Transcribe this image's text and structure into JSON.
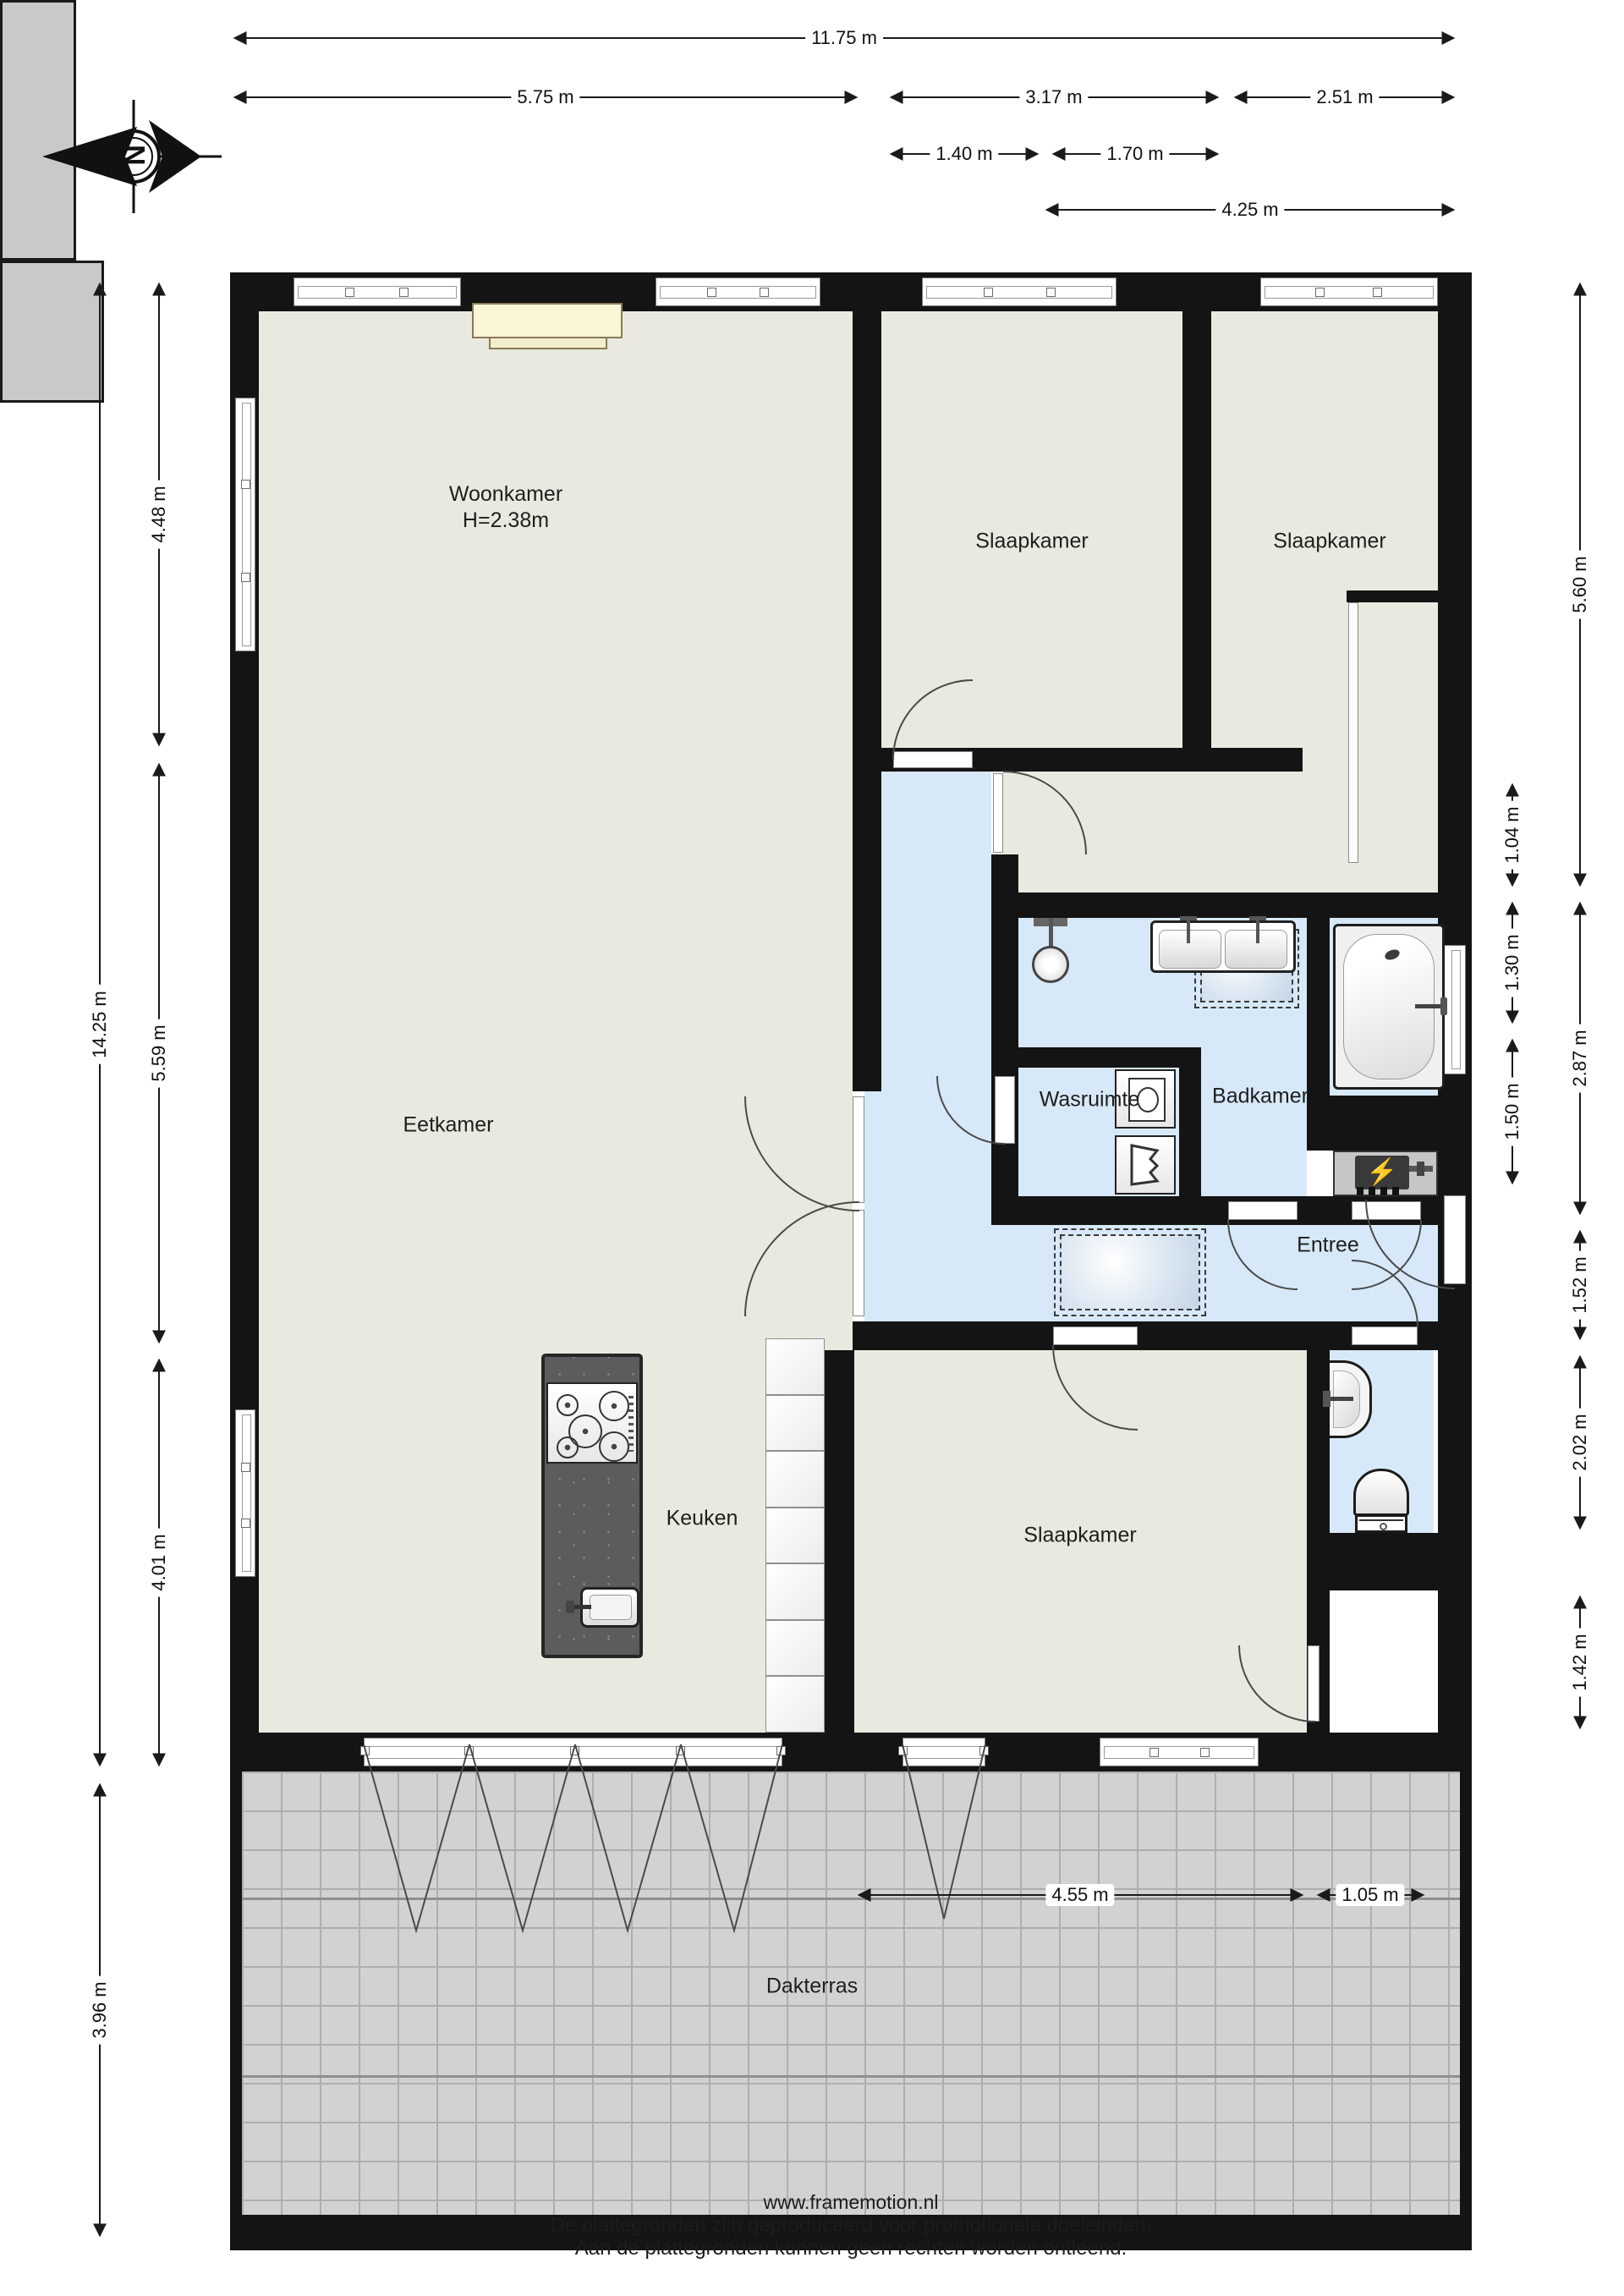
{
  "title": "Plattegrond appartement",
  "compass": {
    "letter": "N"
  },
  "rooms": {
    "woonkamer": {
      "name": "Woonkamer",
      "height": "H=2.38m"
    },
    "slaapkamer_top_middle": "Slaapkamer",
    "slaapkamer_top_right": "Slaapkamer",
    "eetkamer": "Eetkamer",
    "wasruimte": "Wasruimte",
    "badkamer": "Badkamer",
    "entree": "Entree",
    "keuken": "Keuken",
    "slaapkamer_bottom": "Slaapkamer",
    "dakterras": "Dakterras"
  },
  "dims": {
    "t1": "11.75 m",
    "t2": "5.75 m",
    "t3": "3.17 m",
    "t4": "2.51 m",
    "t5": "1.40 m",
    "t6": "1.70 m",
    "t7": "4.25 m",
    "l1": "14.25 m",
    "l2": "4.48 m",
    "l3": "5.59 m",
    "l4": "4.01 m",
    "l5": "3.96 m",
    "r1": "5.60 m",
    "r2": "2.87 m",
    "r3": "1.52 m",
    "r4": "2.02 m",
    "r5": "1.42 m",
    "ri1": "1.04 m",
    "ri2": "1.30 m",
    "ri3": "1.50 m",
    "b1": "4.55 m",
    "b2": "1.05 m"
  },
  "fixtures": {
    "heater_bolt": "⚡"
  },
  "colors": {
    "wall": "#141414",
    "floor_beige": "#eae9df",
    "floor_blue": "#d7e9f8",
    "terrace_gray": "#d2d2d2",
    "closet_gray": "#c9c9c9",
    "island_gray": "#5c5c5c",
    "sideboard_cream": "#faf6d6"
  },
  "footer": {
    "line1": "www.framemotion.nl",
    "line2": "De plattegronden zijn geproduceerd voor promotionele doeleinden.",
    "line3": "Aan de plattegronden kunnen geen rechten worden ontleend."
  }
}
